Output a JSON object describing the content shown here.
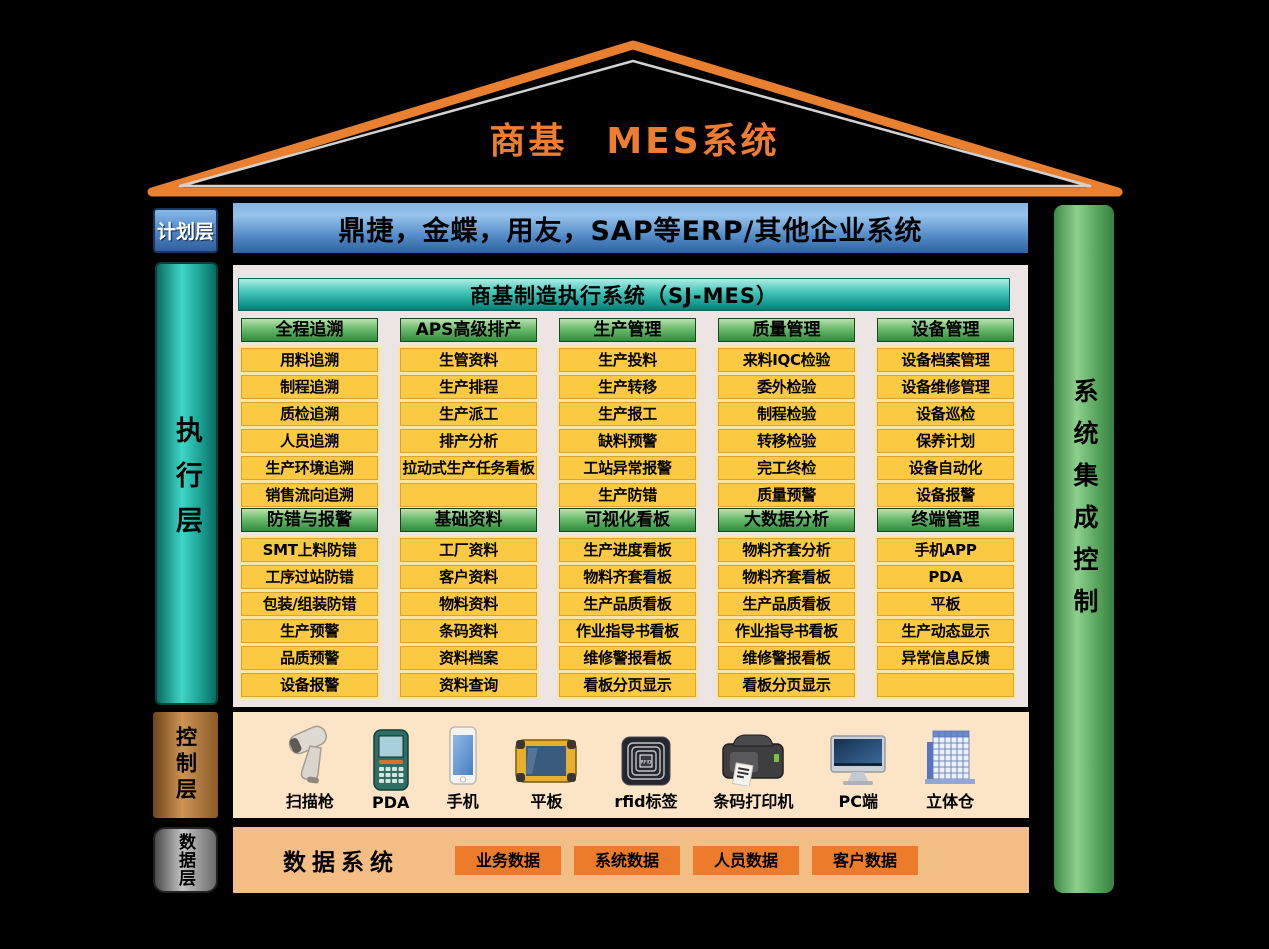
{
  "roof": {
    "title": "商基　MES系统"
  },
  "planning": {
    "layer_label": "计划层",
    "erp_text": "鼎捷，金蝶，用友，SAP等ERP/其他企业系统"
  },
  "execution": {
    "layer_label": "执行层",
    "system_title": "商基制造执行系统（SJ-MES）",
    "rows": [
      [
        {
          "title": "全程追溯",
          "items": [
            "用料追溯",
            "制程追溯",
            "质检追溯",
            "人员追溯",
            "生产环境追溯",
            "销售流向追溯"
          ]
        },
        {
          "title": "APS高级排产",
          "items": [
            "生管资料",
            "生产排程",
            "生产派工",
            "排产分析",
            "拉动式生产任务看板",
            ""
          ]
        },
        {
          "title": "生产管理",
          "items": [
            "生产投料",
            "生产转移",
            "生产报工",
            "缺料预警",
            "工站异常报警",
            "生产防错"
          ]
        },
        {
          "title": "质量管理",
          "items": [
            "来料IQC检验",
            "委外检验",
            "制程检验",
            "转移检验",
            "完工终检",
            "质量预警"
          ]
        },
        {
          "title": "设备管理",
          "items": [
            "设备档案管理",
            "设备维修管理",
            "设备巡检",
            "保养计划",
            "设备自动化",
            "设备报警"
          ]
        }
      ],
      [
        {
          "title": "防错与报警",
          "items": [
            "SMT上料防错",
            "工序过站防错",
            "包装/组装防错",
            "生产预警",
            "品质预警",
            "设备报警"
          ]
        },
        {
          "title": "基础资料",
          "items": [
            "工厂资料",
            "客户资料",
            "物料资料",
            "条码资料",
            "资料档案",
            "资料查询"
          ]
        },
        {
          "title": "可视化看板",
          "items": [
            "生产进度看板",
            "物料齐套看板",
            "生产品质看板",
            "作业指导书看板",
            "维修警报看板",
            "看板分页显示"
          ]
        },
        {
          "title": "大数据分析",
          "items": [
            "物料齐套分析",
            "物料齐套看板",
            "生产品质看板",
            "作业指导书看板",
            "维修警报看板",
            "看板分页显示"
          ]
        },
        {
          "title": "终端管理",
          "items": [
            "手机APP",
            "PDA",
            "平板",
            "生产动态显示",
            "异常信息反馈",
            ""
          ]
        }
      ]
    ]
  },
  "integration": {
    "pillar_label": "系统集成控制"
  },
  "control": {
    "layer_label": "控制层",
    "devices": [
      {
        "icon": "barcode-scanner",
        "label": "扫描枪"
      },
      {
        "icon": "pda",
        "label": "PDA"
      },
      {
        "icon": "phone",
        "label": "手机"
      },
      {
        "icon": "tablet",
        "label": "平板"
      },
      {
        "icon": "rfid-tag",
        "label": "rfid标签"
      },
      {
        "icon": "barcode-printer",
        "label": "条码打印机"
      },
      {
        "icon": "pc",
        "label": "PC端"
      },
      {
        "icon": "warehouse",
        "label": "立体仓"
      }
    ]
  },
  "data_layer": {
    "layer_label": "数据层",
    "title": "数据系统",
    "boxes": [
      "业务数据",
      "系统数据",
      "人员数据",
      "客户数据"
    ]
  },
  "colors": {
    "background": "#000000",
    "roof_orange": "#E8802F",
    "title_orange": "#ED7D31",
    "erp_blue": "#4D86C4",
    "planning_blue": "#4E83C2",
    "exec_teal": "#2BC4B4",
    "sjmes_header_teal": "#17A89B",
    "module_header_green": "#3E9348",
    "module_item_yellow": "#FBCA42",
    "module_item_border": "#DFA22F",
    "panel_bg": "#EDE4E4",
    "right_pillar_green": "#6FBE74",
    "control_copper": "#CE9455",
    "control_bg": "#FCE5C7",
    "data_gray": "#9A9A9A",
    "data_bg": "#F3BE85",
    "data_box_orange": "#EC7C2B"
  }
}
